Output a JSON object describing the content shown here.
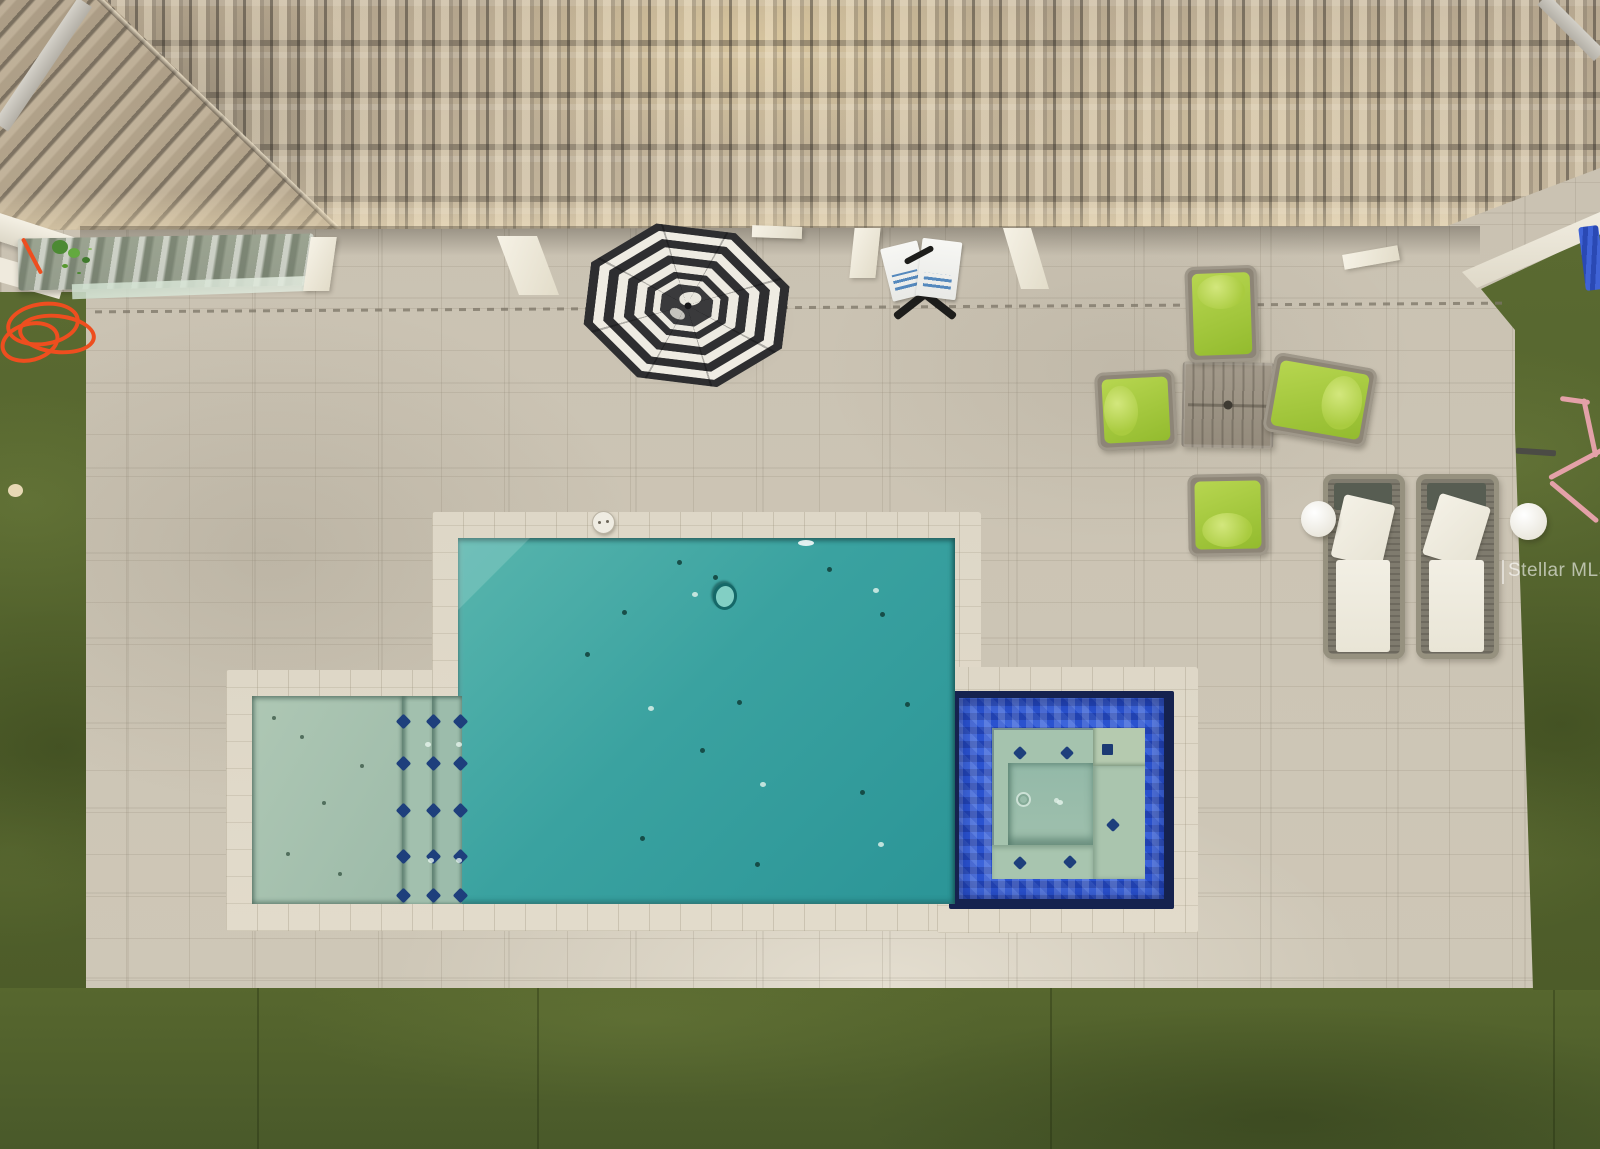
{
  "scene": {
    "description": "Aerial drone photo of a backyard: tile roof, travertine pool deck, rectangular pool with tanning ledge and blue-tiled spa, striped umbrella, patio furniture, artificial turf",
    "watermark": {
      "text": "Stellar MLS"
    },
    "palette": {
      "roof_tan": "#b7a78f",
      "roof_shadow": "#6e675c",
      "roof_sunlit": "#ecd9ae",
      "deck_paver": "#cbc3b3",
      "coping": "#ded7c7",
      "turf_green": "#57672e",
      "turf_dark": "#49592a",
      "pool_teal_light": "#58b5ad",
      "pool_teal_deep": "#2b9597",
      "ledge_sage": "#aec7b4",
      "spa_tile_blue": "#2a52cf",
      "spa_navy": "#15224f",
      "spa_water_sage": "#a5c3ae",
      "accent_diamond_navy": "#1e3f7c",
      "umbrella_black": "#2e2e30",
      "umbrella_white": "#efece3",
      "cushion_lime": "#a7ca3e",
      "cushion_white": "#f1eee3",
      "frame_gray": "#8d8577",
      "cord_orange": "#ee4e1f",
      "tool_pink": "#e4a1a8"
    },
    "counts": {
      "dining_chairs": 4,
      "chaise_lounges": 2,
      "side_tables": 2,
      "umbrellas": 1,
      "spas": 1
    },
    "markers": {
      "step_diamonds": [
        [
          398,
          716
        ],
        [
          428,
          716
        ],
        [
          455,
          716
        ],
        [
          398,
          758
        ],
        [
          428,
          758
        ],
        [
          455,
          758
        ],
        [
          398,
          805
        ],
        [
          428,
          805
        ],
        [
          455,
          805
        ],
        [
          398,
          851
        ],
        [
          428,
          851
        ],
        [
          455,
          851
        ],
        [
          398,
          890
        ],
        [
          428,
          890
        ],
        [
          455,
          890
        ]
      ],
      "spa_diamonds": [
        [
          1015,
          748
        ],
        [
          1062,
          748
        ],
        [
          1108,
          820
        ],
        [
          1015,
          858
        ],
        [
          1065,
          857
        ]
      ],
      "spa_squares": [
        [
          1102,
          744
        ]
      ],
      "dark_specks": [
        [
          677,
          560
        ],
        [
          713,
          575
        ],
        [
          827,
          567
        ],
        [
          622,
          610
        ],
        [
          585,
          652
        ],
        [
          737,
          700
        ],
        [
          905,
          702
        ],
        [
          640,
          836
        ],
        [
          755,
          862
        ],
        [
          860,
          790
        ],
        [
          700,
          748
        ],
        [
          880,
          612
        ]
      ],
      "ledge_specks": [
        [
          300,
          735
        ],
        [
          322,
          801
        ],
        [
          286,
          852
        ],
        [
          360,
          764
        ],
        [
          338,
          872
        ],
        [
          272,
          716
        ]
      ],
      "light_dots": [
        [
          692,
          592
        ],
        [
          873,
          588
        ],
        [
          648,
          706
        ],
        [
          760,
          782
        ],
        [
          878,
          842
        ],
        [
          425,
          742
        ],
        [
          456,
          742
        ],
        [
          428,
          858
        ],
        [
          456,
          858
        ],
        [
          1057,
          800
        ]
      ]
    }
  }
}
